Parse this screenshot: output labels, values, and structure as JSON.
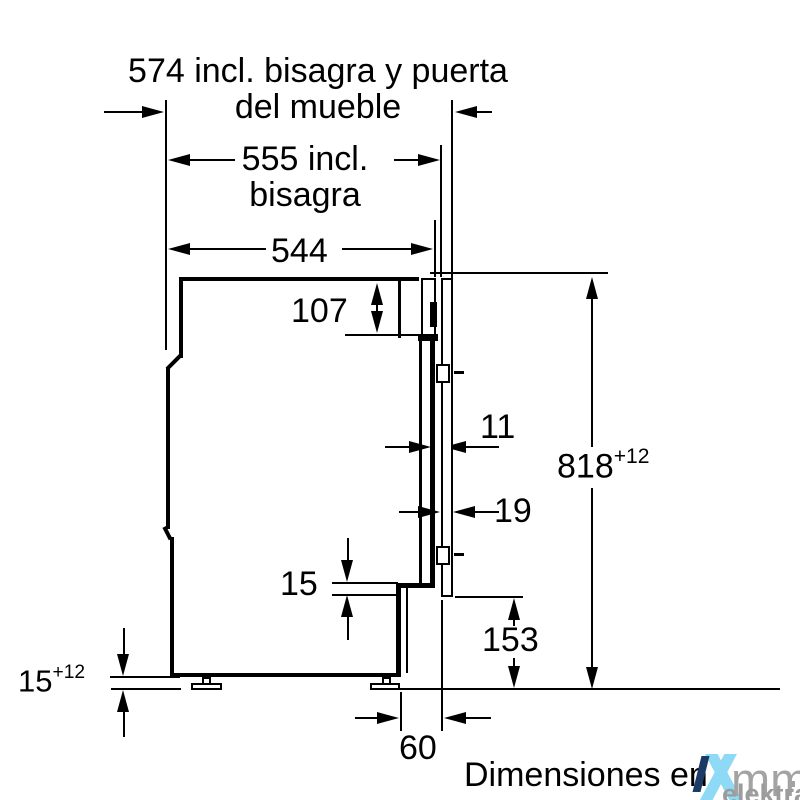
{
  "diagram": {
    "top_label_line1": "574 incl. bisagra y puerta",
    "top_label_line2": "del mueble",
    "mid_label_line1": "555 incl.",
    "mid_label_line2": "bisagra",
    "depth_label": "544",
    "top_offset_label": "107",
    "gap_label": "11",
    "door_thickness_label": "19",
    "height_value": "818",
    "height_tolerance": "+12",
    "step_label": "15",
    "plinth_height_label": "153",
    "foot_value": "15",
    "foot_tolerance": "+12",
    "plinth_depth_label": "60",
    "caption": "Dimensiones en",
    "line_color": "#000000"
  },
  "watermark": {
    "brand": "mm",
    "name": "elektra",
    "blue": "#8ed9f5",
    "navy": "#1b3a66",
    "gray": "#a3a3a3"
  }
}
